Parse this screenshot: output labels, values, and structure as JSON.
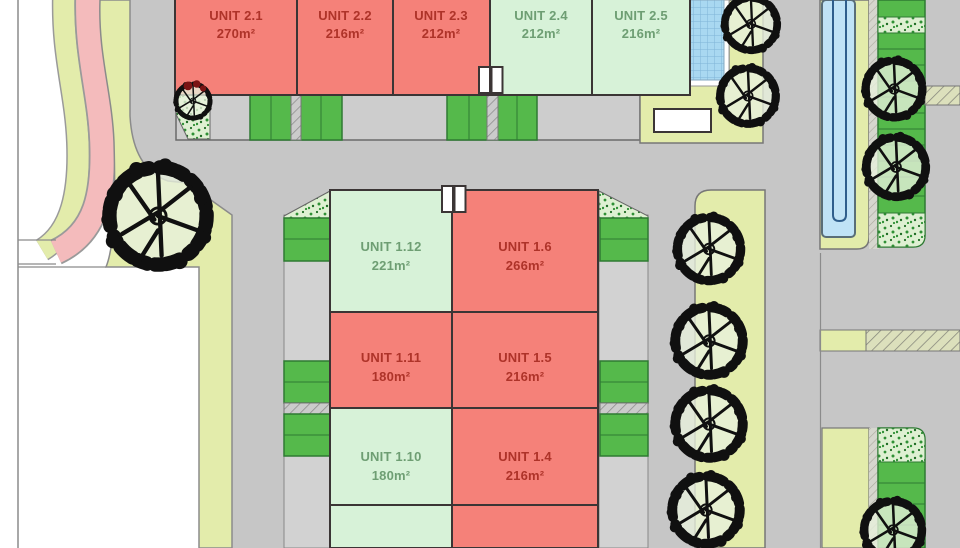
{
  "plan": {
    "units": [
      {
        "id": "2.1",
        "name": "UNIT 2.1",
        "area": "270m²",
        "status": "red"
      },
      {
        "id": "2.2",
        "name": "UNIT 2.2",
        "area": "216m²",
        "status": "red"
      },
      {
        "id": "2.3",
        "name": "UNIT 2.3",
        "area": "212m²",
        "status": "red"
      },
      {
        "id": "2.4",
        "name": "UNIT 2.4",
        "area": "212m²",
        "status": "green"
      },
      {
        "id": "2.5",
        "name": "UNIT 2.5",
        "area": "216m²",
        "status": "green"
      },
      {
        "id": "1.12",
        "name": "UNIT 1.12",
        "area": "221m²",
        "status": "green"
      },
      {
        "id": "1.6",
        "name": "UNIT 1.6",
        "area": "266m²",
        "status": "red"
      },
      {
        "id": "1.11",
        "name": "UNIT 1.11",
        "area": "180m²",
        "status": "red"
      },
      {
        "id": "1.5",
        "name": "UNIT 1.5",
        "area": "216m²",
        "status": "red"
      },
      {
        "id": "1.10",
        "name": "UNIT 1.10",
        "area": "180m²",
        "status": "green"
      },
      {
        "id": "1.4",
        "name": "UNIT 1.4",
        "area": "216m²",
        "status": "red"
      },
      {
        "id": "",
        "name": "",
        "area": "",
        "status": "green"
      },
      {
        "id": "",
        "name": "",
        "area": "",
        "status": "red"
      }
    ]
  },
  "colors": {
    "unit_red": "#F58179",
    "unit_green": "#D7F2D8",
    "text_red": "#AE3329",
    "text_green": "#6E9E73",
    "road": "#C6C6C6",
    "road_row": "#CDCDCD",
    "strip_gray": "#D2D2D2",
    "landscape": "#E3ECAB",
    "footpath_pink": "#F4BBBC",
    "bay_green": "#55B94B",
    "bay_border": "#2E7A33",
    "speckle_bg": "#DEF0D2",
    "speckle_dot": "#2F9035",
    "water": "#C0E3F6",
    "water_edge": "#5A6E78",
    "water_line": "#2F5E8C",
    "pool": "#A9D8F1",
    "pool_grid": "#7FB4D8",
    "outline": "#3B3535",
    "line_gray": "#8B8B8B",
    "hatch_bg": "#CBCBCB",
    "hatch_line": "#8F8F8F",
    "hatchy_bg": "#DCE0BC",
    "hatchy_line": "#84857A",
    "curb": "#D6D6CE",
    "tree_ink": "#101010",
    "tree_fill": "#E8F1DC",
    "tree_accent": "#7A1414",
    "white": "#FFFFFF"
  }
}
